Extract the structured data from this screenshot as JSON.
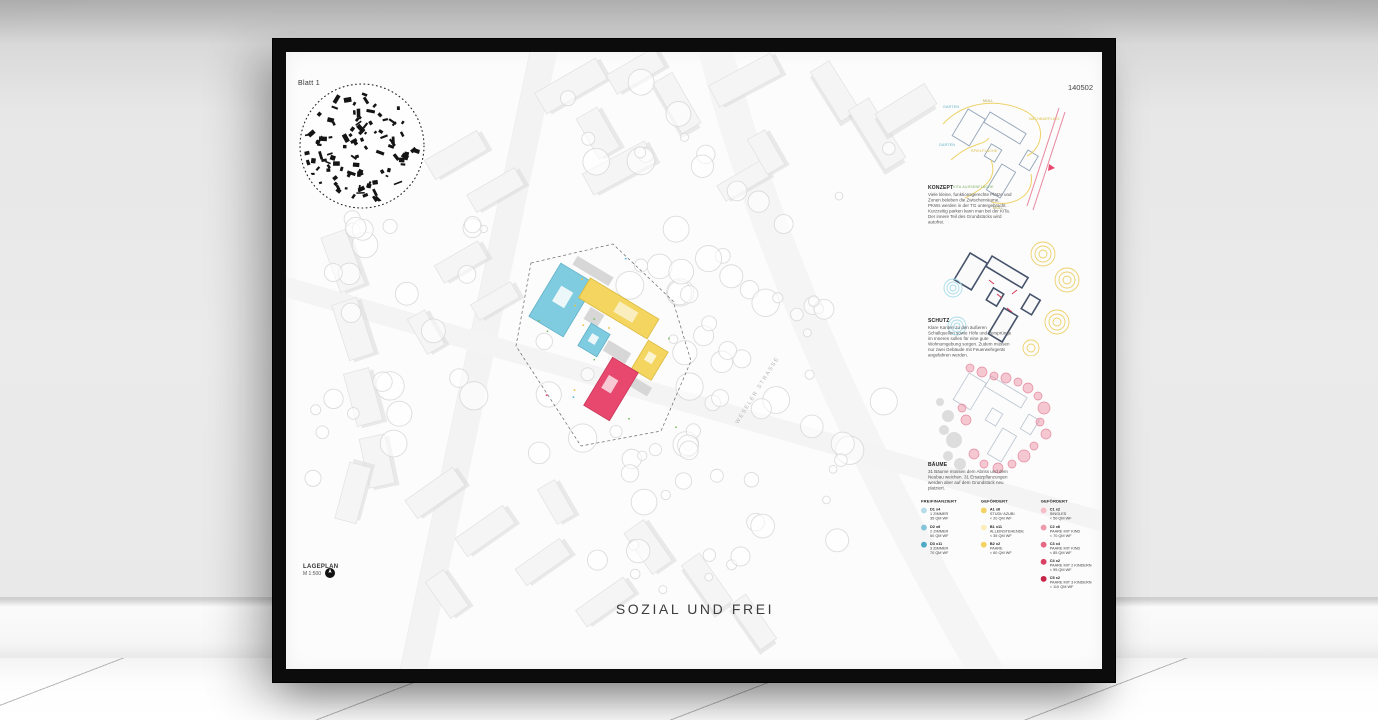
{
  "poster": {
    "sheet_label": "Blatt 1",
    "sheet_number": "140502",
    "title": "SOZIAL UND FREI",
    "plan": {
      "label": "LAGEPLAN",
      "scale": "M 1:500",
      "street_label": "WESELER STRASSE"
    },
    "sections": [
      {
        "heading": "KONZEPT",
        "body": "Viele kleine, funktionsgerechte Plätze und Zonen beleben die Zwischenräume. PKWs werden in der TG untergebracht. Kurzzeitig parken kann man bei der KiTa. Der innere Teil des Grundstücks wird autofrei."
      },
      {
        "heading": "SCHUTZ",
        "body": "Klare Kanten zu den äußeren Schallquellen sowie Höfe und Versprünge im Inneren sollen für eine gute Wohnumgebung sorgen. Zudem müssen nur zwei Gebäude mit Feuerwehrgerät angefahren werden."
      },
      {
        "heading": "BÄUME",
        "body": "31 Bäume müssen dem Abriss und dem Neubau weichen. 31 Ersatzpflanzungen werden aber auf dem Grundstück neu platziert."
      }
    ],
    "concept_labels": [
      "GARTEN",
      "MÜLL",
      "NACHBARPLATZ",
      "GARTEN",
      "SPIELFLÄCHE",
      "KITA AUSSENFLÄCHE",
      "MÜLL"
    ],
    "legend": {
      "columns": [
        {
          "heading": "FREIFINANZIERT",
          "items": [
            {
              "code": "D1 x4",
              "line1": "1 ZIMMER",
              "line2": "35 QM WF",
              "color": "#b5dce9"
            },
            {
              "code": "D2 x6",
              "line1": "2 ZIMMER",
              "line2": "50 QM WF",
              "color": "#84c5da"
            },
            {
              "code": "D3 x11",
              "line1": "3 ZIMMER",
              "line2": "70 QM WF",
              "color": "#4fa9c6"
            }
          ]
        },
        {
          "heading": "GEFÖRDERT",
          "items": [
            {
              "code": "A1 x6",
              "line1": "STUDI/ AZUBI",
              "line2": "< 20 QM WF",
              "color": "#f4d263"
            },
            {
              "code": "B1 x11",
              "line1": "ALLEINSTEHENDE",
              "line2": "< 35 QM WF",
              "color": "#faeebc"
            },
            {
              "code": "B2 x2",
              "line1": "PAARE",
              "line2": "< 60 QM WF",
              "color": "#f4d263"
            }
          ]
        },
        {
          "heading": "GEFÖRDERT",
          "items": [
            {
              "code": "C1 x2",
              "line1": "SINGLES",
              "line2": "< 50 QM WF",
              "color": "#f6bcc8"
            },
            {
              "code": "C2 x6",
              "line1": "PAARE MIT KIND",
              "line2": "< 70 QM WF",
              "color": "#f09aad"
            },
            {
              "code": "C3 x4",
              "line1": "PAARE MIT KIND",
              "line2": "< 85 QM WF",
              "color": "#e76784"
            },
            {
              "code": "C4 x2",
              "line1": "PAARE MIT 2 KINDERN",
              "line2": "< 95 QM WF",
              "color": "#da3f64"
            },
            {
              "code": "C5 x2",
              "line1": "PAARE MIT 3 KINDERN",
              "line2": "< 110 QM WF",
              "color": "#c62548"
            }
          ]
        }
      ]
    },
    "colors": {
      "accent_blue": "#7fcbdf",
      "accent_yellow": "#f3d55f",
      "accent_pink": "#e8486e",
      "frame": "#0c0c0c",
      "wall": "#e9e9e9"
    }
  }
}
